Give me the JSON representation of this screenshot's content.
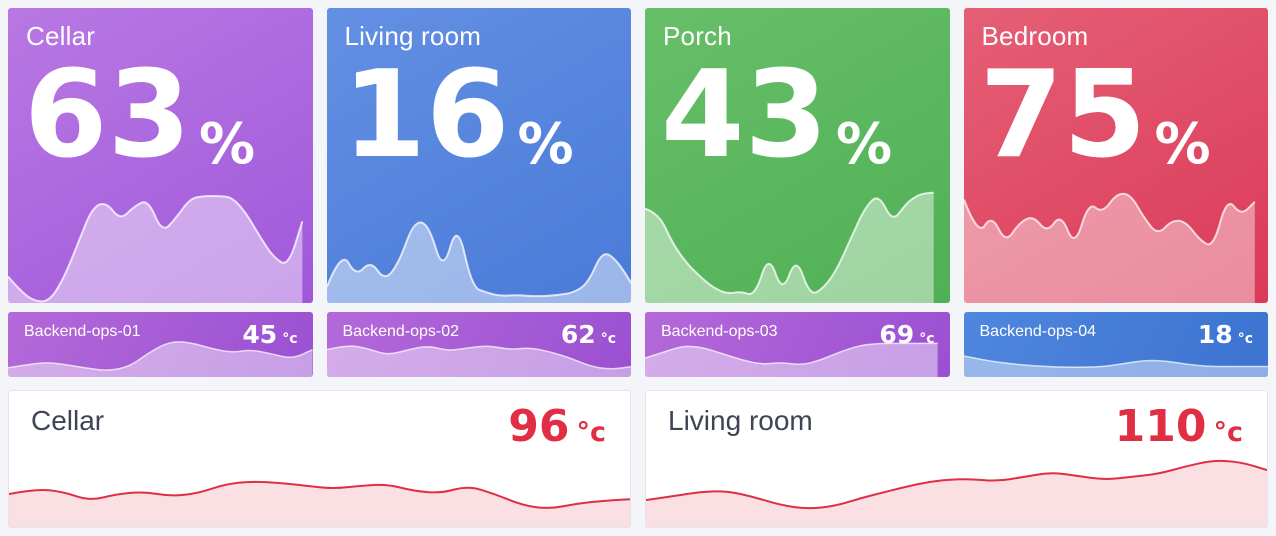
{
  "page": {
    "background": "#f4f5f9"
  },
  "top_tiles": [
    {
      "title": "Cellar",
      "value": "63",
      "unit": "%",
      "gradient": {
        "angle": 150,
        "from": "#b878e3",
        "to": "#a058da"
      }
    },
    {
      "title": "Living room",
      "value": "16",
      "unit": "%",
      "gradient": {
        "angle": 150,
        "from": "#6390e3",
        "to": "#4a7ad8"
      }
    },
    {
      "title": "Porch",
      "value": "43",
      "unit": "%",
      "gradient": {
        "angle": 150,
        "from": "#67bf69",
        "to": "#50b055"
      }
    },
    {
      "title": "Bedroom",
      "value": "75",
      "unit": "%",
      "gradient": {
        "angle": 150,
        "from": "#e55f75",
        "to": "#db3a59"
      }
    }
  ],
  "mini_tiles": [
    {
      "title": "Backend-ops-01",
      "value": "45",
      "unit": "°c",
      "gradient": {
        "angle": 115,
        "from": "#b469d9",
        "to": "#9a50d2"
      }
    },
    {
      "title": "Backend-ops-02",
      "value": "62",
      "unit": "°c",
      "gradient": {
        "angle": 115,
        "from": "#b469d9",
        "to": "#9a50d2"
      }
    },
    {
      "title": "Backend-ops-03",
      "value": "69",
      "unit": "°c",
      "gradient": {
        "angle": 115,
        "from": "#b469d9",
        "to": "#9a50d2"
      }
    },
    {
      "title": "Backend-ops-04",
      "value": "18",
      "unit": "°c",
      "gradient": {
        "angle": 115,
        "from": "#4f86de",
        "to": "#3d73d1"
      }
    }
  ],
  "bottom_panels": [
    {
      "title": "Cellar",
      "value": "96",
      "unit": "°c",
      "value_color": "#e02f44"
    },
    {
      "title": "Living room",
      "value": "110",
      "unit": "°c",
      "value_color": "#e02f44"
    }
  ],
  "chart_data": [
    {
      "type": "area",
      "panel": "Cellar",
      "stat": 63,
      "unit": "%",
      "values_rel": [
        0.23,
        0.09,
        0.01,
        0.02,
        0.22,
        0.52,
        0.83,
        0.88,
        0.72,
        0.84,
        0.9,
        0.61,
        0.74,
        0.91,
        0.93,
        0.93,
        0.92,
        0.78,
        0.57,
        0.39,
        0.32,
        0.71
      ],
      "fill": "rgba(255,255,255,0.45)",
      "stroke": "rgba(255,255,255,0.75)",
      "stroke_width": 2,
      "svg": {
        "w": 300,
        "h": 115,
        "cut": 290
      }
    },
    {
      "type": "area",
      "panel": "Living room",
      "stat": 16,
      "unit": "%",
      "values_rel": [
        0.14,
        0.46,
        0.23,
        0.37,
        0.19,
        0.36,
        0.71,
        0.69,
        0.26,
        0.71,
        0.14,
        0.09,
        0.06,
        0.07,
        0.06,
        0.06,
        0.07,
        0.09,
        0.17,
        0.46,
        0.37,
        0.17
      ],
      "fill": "rgba(255,255,255,0.45)",
      "stroke": "rgba(255,255,255,0.75)",
      "stroke_width": 2,
      "svg": {
        "w": 305,
        "h": 70
      }
    },
    {
      "type": "area",
      "panel": "Porch",
      "stat": 43,
      "unit": "%",
      "values_rel": [
        0.82,
        0.78,
        0.52,
        0.35,
        0.23,
        0.13,
        0.08,
        0.1,
        0.06,
        0.43,
        0.08,
        0.41,
        0.06,
        0.13,
        0.3,
        0.57,
        0.83,
        0.95,
        0.7,
        0.87,
        0.95,
        0.96
      ],
      "fill": "rgba(255,255,255,0.45)",
      "stroke": "rgba(255,255,255,0.75)",
      "stroke_width": 2,
      "svg": {
        "w": 308,
        "h": 115,
        "cut": 292
      }
    },
    {
      "type": "area",
      "panel": "Bedroom",
      "stat": 75,
      "unit": "%",
      "values_rel": [
        0.9,
        0.58,
        0.77,
        0.52,
        0.7,
        0.76,
        0.61,
        0.78,
        0.48,
        0.88,
        0.78,
        0.95,
        0.95,
        0.74,
        0.59,
        0.72,
        0.71,
        0.55,
        0.48,
        0.92,
        0.76,
        0.88
      ],
      "fill": "rgba(255,255,255,0.42)",
      "stroke": "rgba(255,255,255,0.72)",
      "stroke_width": 2,
      "svg": {
        "w": 311,
        "h": 115,
        "cut": 297
      }
    },
    {
      "type": "area",
      "panel": "Backend-ops-01",
      "stat": 45,
      "unit": "°c",
      "values_rel": [
        0.22,
        0.3,
        0.35,
        0.28,
        0.2,
        0.15,
        0.25,
        0.6,
        0.85,
        0.82,
        0.68,
        0.58,
        0.65,
        0.55,
        0.43,
        0.65
      ],
      "fill": "rgba(255,255,255,0.45)",
      "stroke": "rgba(255,255,255,0.7)",
      "stroke_width": 1.5,
      "svg": {
        "w": 300,
        "h": 42
      }
    },
    {
      "type": "area",
      "panel": "Backend-ops-02",
      "stat": 62,
      "unit": "°c",
      "values_rel": [
        0.65,
        0.77,
        0.68,
        0.52,
        0.65,
        0.75,
        0.62,
        0.7,
        0.75,
        0.65,
        0.7,
        0.6,
        0.45,
        0.25,
        0.18,
        0.25
      ],
      "fill": "rgba(255,255,255,0.45)",
      "stroke": "rgba(255,255,255,0.7)",
      "stroke_width": 1.5,
      "svg": {
        "w": 305,
        "h": 42
      }
    },
    {
      "type": "area",
      "panel": "Backend-ops-03",
      "stat": 69,
      "unit": "°c",
      "values_rel": [
        0.45,
        0.6,
        0.75,
        0.7,
        0.55,
        0.4,
        0.3,
        0.35,
        0.28,
        0.4,
        0.6,
        0.75,
        0.8,
        0.8,
        0.8,
        0.8
      ],
      "fill": "rgba(255,255,255,0.45)",
      "stroke": "rgba(255,255,255,0.7)",
      "stroke_width": 1.5,
      "svg": {
        "w": 308,
        "h": 42,
        "cut": 296
      }
    },
    {
      "type": "area",
      "panel": "Backend-ops-04",
      "stat": 18,
      "unit": "°c",
      "values_rel": [
        0.5,
        0.4,
        0.33,
        0.28,
        0.25,
        0.23,
        0.23,
        0.25,
        0.33,
        0.4,
        0.38,
        0.3,
        0.25,
        0.25,
        0.25,
        0.25
      ],
      "fill": "rgba(255,255,255,0.42)",
      "stroke": "rgba(255,255,255,0.7)",
      "stroke_width": 1.5,
      "svg": {
        "w": 311,
        "h": 42
      }
    },
    {
      "type": "area",
      "panel": "Cellar",
      "stat": 96,
      "unit": "°c",
      "values_rel": [
        0.44,
        0.51,
        0.47,
        0.35,
        0.44,
        0.47,
        0.41,
        0.45,
        0.57,
        0.61,
        0.59,
        0.55,
        0.51,
        0.55,
        0.57,
        0.48,
        0.45,
        0.55,
        0.44,
        0.29,
        0.24,
        0.31,
        0.35,
        0.37
      ],
      "fill": "rgba(224,47,68,0.15)",
      "stroke": "#e02f44",
      "stroke_width": 2,
      "svg": {
        "w": 624,
        "h": 75
      }
    },
    {
      "type": "area",
      "panel": "Living room",
      "stat": 110,
      "unit": "°c",
      "values_rel": [
        0.36,
        0.41,
        0.47,
        0.48,
        0.4,
        0.29,
        0.24,
        0.28,
        0.39,
        0.48,
        0.57,
        0.63,
        0.64,
        0.61,
        0.67,
        0.73,
        0.68,
        0.63,
        0.67,
        0.71,
        0.81,
        0.89,
        0.87,
        0.76
      ],
      "fill": "rgba(224,47,68,0.15)",
      "stroke": "#e02f44",
      "stroke_width": 2,
      "svg": {
        "w": 623,
        "h": 75
      }
    }
  ]
}
